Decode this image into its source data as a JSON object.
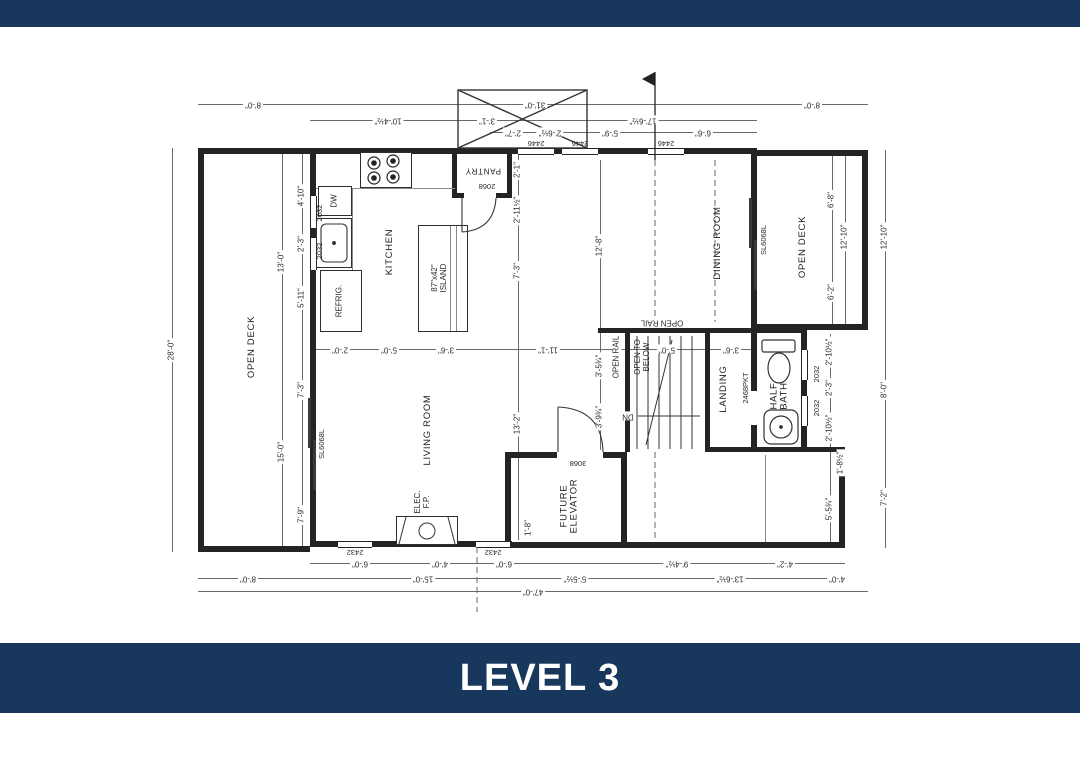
{
  "colors": {
    "banner_navy": "#17375C",
    "ink": "#2a2a2a"
  },
  "banner": {
    "title": "LEVEL 3"
  },
  "plan": {
    "rooms": {
      "kitchen": "KITCHEN",
      "living_room": "LIVING ROOM",
      "dining_room": "DINING ROOM",
      "open_deck_left": "OPEN DECK",
      "open_deck_right": "OPEN DECK",
      "landing": "LANDING",
      "half_bath": [
        "HALF",
        "BATH"
      ],
      "future_elevator": [
        "FUTURE",
        "ELEVATOR"
      ],
      "pantry": "PANTRY",
      "island": [
        "87\"x42\"",
        "ISLAND"
      ],
      "open_to_below": [
        "OPEN TO",
        "BELOW"
      ],
      "open_rail_top": "OPEN RAIL",
      "open_rail_side": "OPEN RAIL",
      "elec_fp": [
        "ELEC.",
        "F.P."
      ],
      "refrig": "REFRIG.",
      "dw": "DW",
      "dn": "DN",
      "stair_pocket_door": "2468PKT"
    },
    "openings": {
      "top_windows": [
        "2446",
        "2446",
        "2446"
      ],
      "left_windows": [
        "2032",
        "2032"
      ],
      "bottom_windows": [
        "2432",
        "2432"
      ],
      "bath_windows": [
        "2032",
        "2032"
      ],
      "left_slider": "SL6068L",
      "dining_slider": "SL6068L",
      "pantry_door": "2068",
      "elevator_door": "3068"
    },
    "dims": {
      "top": [
        "8'-0\"",
        "31'-0\"",
        "8'-0\"",
        "10'-4½\"",
        "3'-1\"",
        "17'-6½\"",
        "2'-7\"",
        "2'-6½\"",
        "5'-9\"",
        "6'-6\""
      ],
      "left": [
        "28'-0\"",
        "4'-10\"",
        "13'-0\"",
        "2'-3\"",
        "5'-11\"",
        "7'-3\"",
        "15'-0\"",
        "7'-9\""
      ],
      "bottom": [
        "6'-0\"",
        "4'-0\"",
        "6'-0\"",
        "9'-4½\"",
        "4'-2\"",
        "8'-0\"",
        "15'-0\"",
        "5'-5½\"",
        "13'-6½\"",
        "4'-0\"",
        "47'-0\""
      ],
      "right": [
        "6'-8\"",
        "12'-10\"",
        "6'-2\"",
        "12'-10\"",
        "2'-10½\"",
        "2'-3\"",
        "2'-10½\"",
        "8'-0\"",
        "1'-8½\"",
        "5'-5¾\"",
        "7'-2\""
      ],
      "interior": [
        "2'-0\"",
        "5'-0\"",
        "3'-6\"",
        "11'-1\"",
        "2'-1\"",
        "2'-11½\"",
        "7'-3\"",
        "12'-8\"",
        "13'-2\"",
        "1'-8\"",
        "3'-5¾\"",
        "3'-9¾\"",
        "5'-0\"",
        "3'-6\""
      ]
    }
  }
}
